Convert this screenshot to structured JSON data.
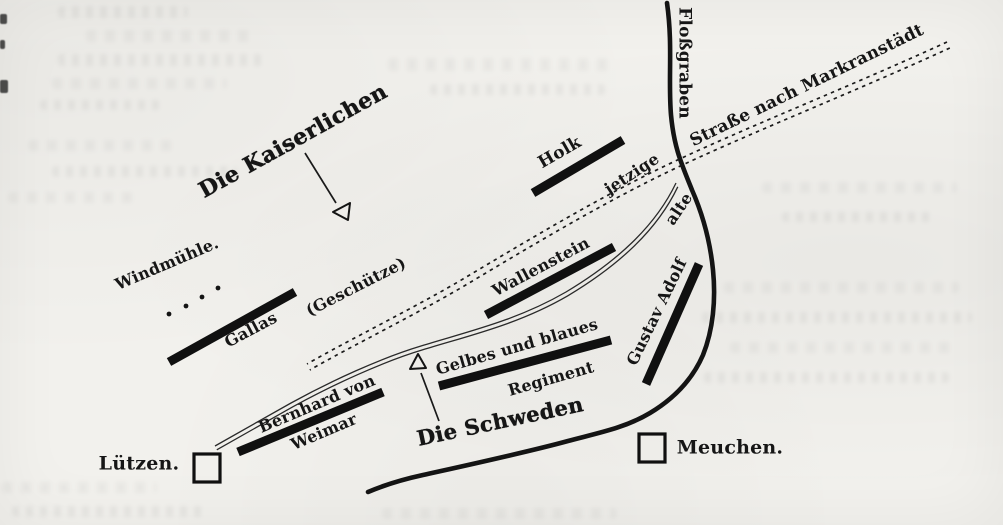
{
  "labels": {
    "imperials": "Die Kaiserlichen",
    "swedes": "Die Schweden",
    "flossgraben": "Floßgraben",
    "strasse_markranstaedt": "Straße nach Markranstädt",
    "jetzige": "jetzige",
    "alte": "alte",
    "holk": "Holk",
    "windmuehle": "Windmühle.",
    "gallas": "Gallas",
    "geschuetze": "(Geschütze)",
    "wallenstein": "Wallenstein",
    "gelbes_und_blaues": "Gelbes und blaues",
    "regiment": "Regiment",
    "gustav_adolf": "Gustav Adolf",
    "bernhard_von": "Bernhard von",
    "weimar": "Weimar",
    "luetzen": "Lützen.",
    "meuchen": "Meuchen."
  },
  "symbols": {
    "luetzen_square": "open-square-village-marker",
    "meuchen_square": "open-square-village-marker",
    "imperial_triangle": "open-triangle-front-marker",
    "swedish_triangle": "open-triangle-front-marker",
    "windmill_battery_dots_count": 4,
    "troop_position_bars": [
      "Holk",
      "Gallas",
      "Wallenstein",
      "Gelbes und blaues Regiment",
      "Bernhard von Weimar",
      "Gustav Adolf"
    ]
  },
  "colors": {
    "ink": "#141414",
    "paper": "#f2f1ed"
  }
}
